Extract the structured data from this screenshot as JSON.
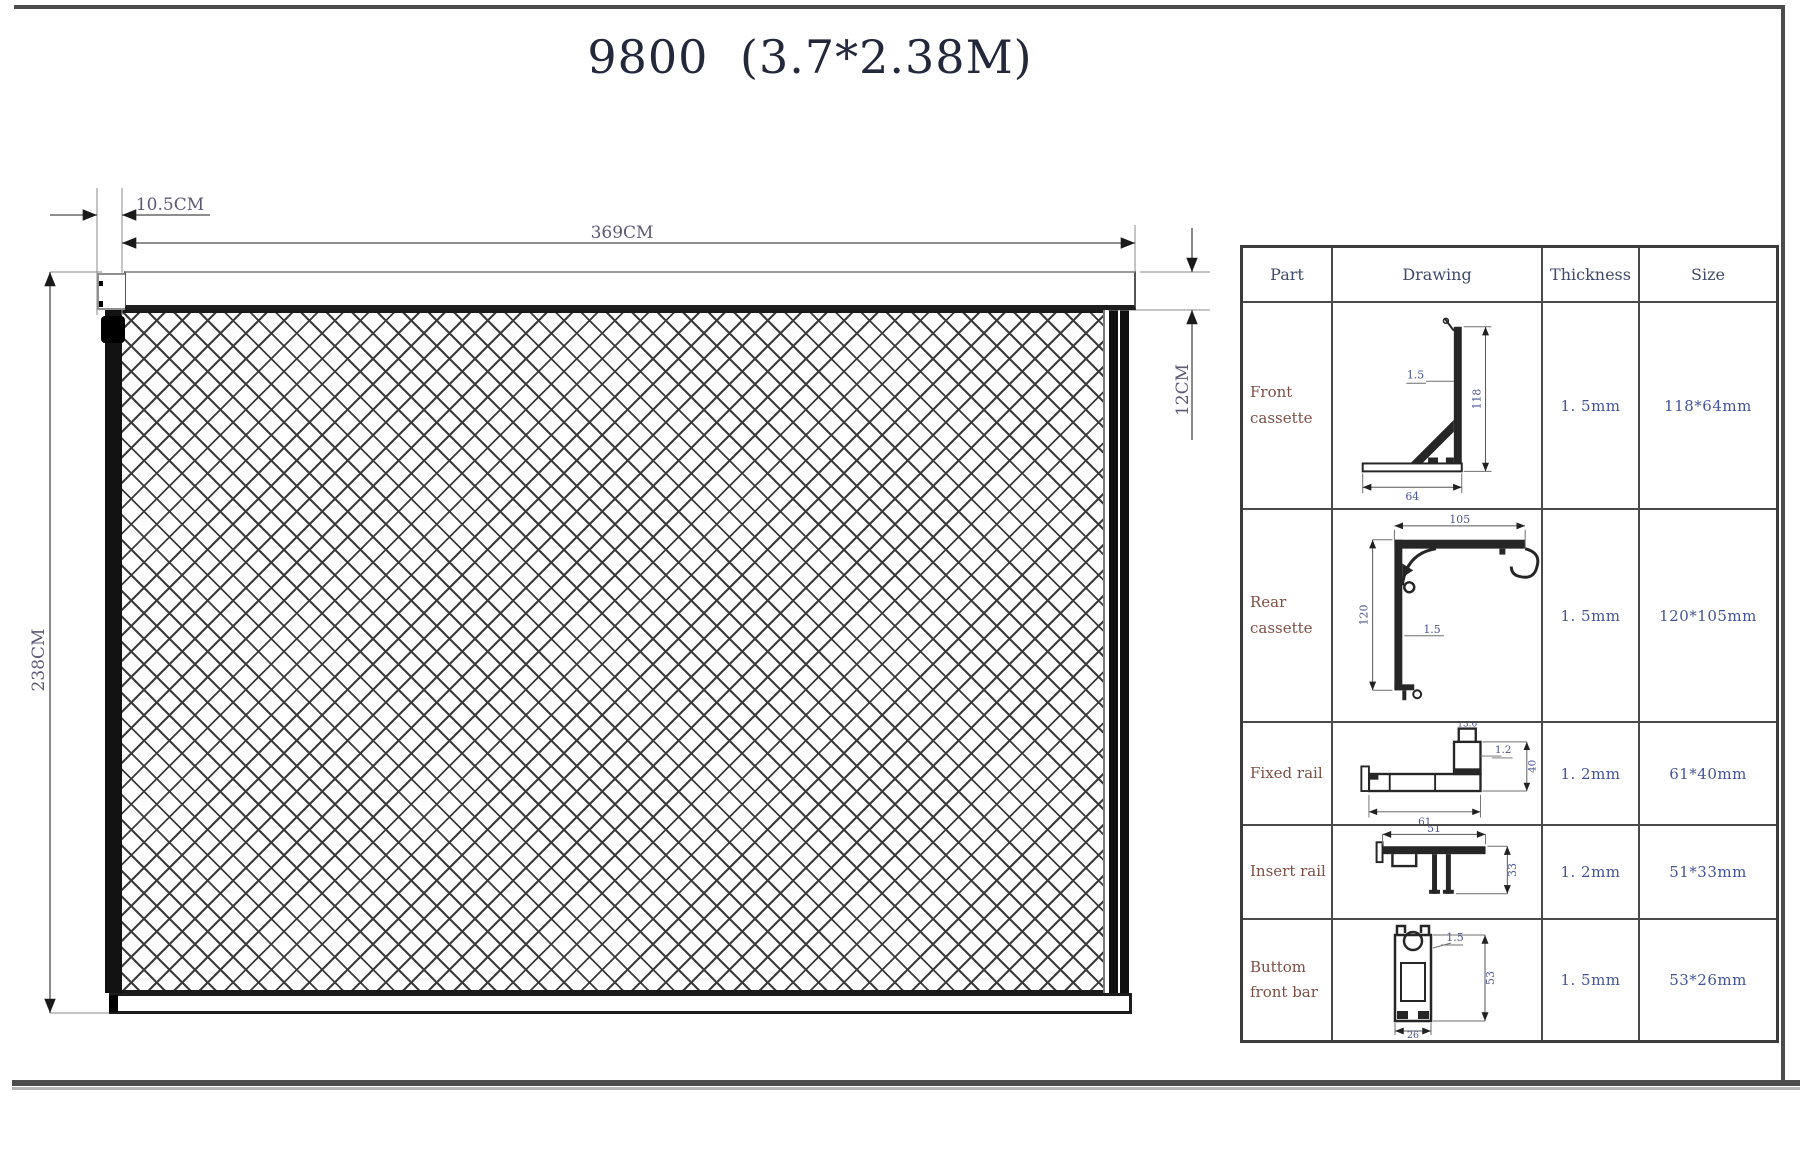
{
  "sheet": {
    "title": "9800 (3.7*2.38M)"
  },
  "main_drawing": {
    "dims": {
      "offset": "10.5CM",
      "width": "369CM",
      "height": "238CM",
      "cassette_height": "12CM"
    }
  },
  "table": {
    "headers": [
      "Part",
      "Drawing",
      "Thickness",
      "Size"
    ],
    "rows": [
      {
        "part": "Front cassette",
        "thickness": "1. 5mm",
        "size": "118*64mm",
        "drawing_labels": {
          "leader": "1.5",
          "height": "118",
          "width": "64"
        }
      },
      {
        "part": "Rear cassette",
        "thickness": "1. 5mm",
        "size": "120*105mm",
        "drawing_labels": {
          "leader": "1.5",
          "height": "120",
          "width": "105"
        }
      },
      {
        "part": "Fixed rail",
        "thickness": "1. 2mm",
        "size": "61*40mm",
        "drawing_labels": {
          "leader": "1.2",
          "height": "40",
          "width": "61",
          "notch": "13.6"
        }
      },
      {
        "part": "Insert rail",
        "thickness": "1. 2mm",
        "size": "51*33mm",
        "drawing_labels": {
          "width": "51",
          "height": "33"
        }
      },
      {
        "part": "Buttom front bar",
        "thickness": "1. 5mm",
        "size": "53*26mm",
        "drawing_labels": {
          "leader": "1.5",
          "height": "53",
          "width": "26"
        }
      }
    ]
  },
  "colors": {
    "ink": "#262626",
    "frame": "#4c4c4c",
    "dim_label": "#5d5a75",
    "table_value": "#44549b",
    "part_label": "#7d4f45"
  }
}
